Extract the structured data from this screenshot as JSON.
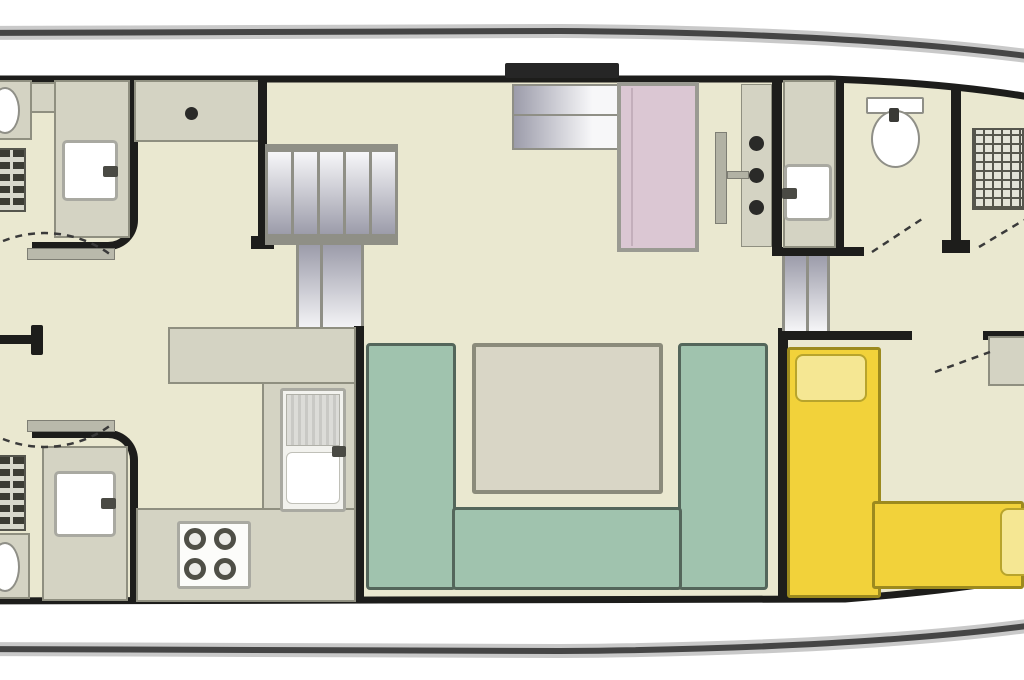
{
  "diagram": {
    "type": "boat-floorplan",
    "title": "Houseboat deck plan",
    "orientation": "stern-left-bow-right"
  },
  "colors": {
    "background": "#ffffff",
    "hull_line": "#454545",
    "hull_halo": "#c9c9c9",
    "wall": "#1d1d1b",
    "floor": "#eae8d0",
    "counter": "#d4d3c3",
    "counter_edge": "#8f8f80",
    "fixture": "#ffffff",
    "fixture_edge": "#9b9b93",
    "radiator_dark": "#3c3c34",
    "radiator_light": "#d8d8cc",
    "stairs_light": "#f7f7f9",
    "stairs_dark": "#9c9caa",
    "stairs_rail": "#8f8f86",
    "teal": "#a0c3ae",
    "teal_edge": "#54665b",
    "table": "#d9d6c6",
    "table_edge": "#8b8b7b",
    "yellow": "#f2d23a",
    "yellow_light": "#f5e793",
    "yellow_edge": "#9c8a1e",
    "pink": "#dbc7d3",
    "pink_edge": "#9a9a92",
    "dot": "#2a2a28",
    "door": "#b9b9ab",
    "door_edge": "#7e7e74",
    "dash": "#3a3a3a",
    "hatch": "#262626"
  },
  "rooms": [
    {
      "name": "bathroom-top-left",
      "fixtures": [
        "toilet",
        "washbasin",
        "radiator"
      ]
    },
    {
      "name": "bathroom-bottom-left",
      "fixtures": [
        "toilet",
        "washbasin",
        "radiator"
      ]
    },
    {
      "name": "corridor-left",
      "fixtures": [
        "cabin-door-top",
        "cabin-door-bottom"
      ]
    },
    {
      "name": "galley",
      "fixtures": [
        "u-shaped-counter",
        "double-sink",
        "four-burner-stove"
      ]
    },
    {
      "name": "saloon",
      "fixtures": [
        "roof-hatch-steps",
        "pink-wardrobe",
        "bar-counter-with-stools",
        "u-shaped-teal-dinette",
        "dinette-table",
        "main-staircase"
      ]
    },
    {
      "name": "bathroom-top-right",
      "fixtures": [
        "washbasin",
        "toilet"
      ]
    },
    {
      "name": "bow-cabin-top",
      "fixtures": [
        "radiator",
        "door"
      ]
    },
    {
      "name": "bow-cabin-bottom",
      "fixtures": [
        "yellow-l-sofa",
        "cushions",
        "side-table",
        "door"
      ]
    }
  ],
  "furniture_legend": {
    "teal_item": "dinette seating",
    "yellow_item": "sofa seating",
    "pink_item": "wardrobe",
    "gray_item": "counter / cabinet",
    "gradient_item": "steps / stairs",
    "dashed_line": "door swing"
  }
}
